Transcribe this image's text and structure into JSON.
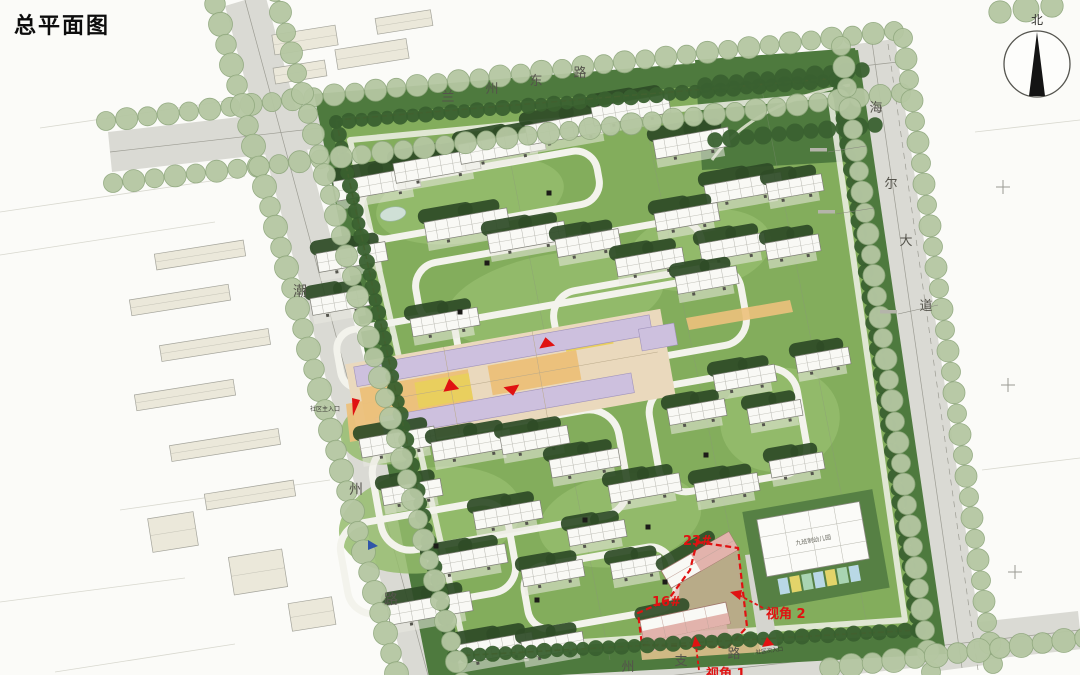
{
  "title": "总平面图",
  "compass": {
    "north_label": "北"
  },
  "roads": {
    "north": {
      "name": "兰州东路",
      "chars": [
        {
          "c": "兰",
          "x": 448,
          "y": 101
        },
        {
          "c": "州",
          "x": 492,
          "y": 93
        },
        {
          "c": "东",
          "x": 536,
          "y": 85
        },
        {
          "c": "路",
          "x": 580,
          "y": 77
        }
      ]
    },
    "east": {
      "name": "海尔大道",
      "chars": [
        {
          "c": "海",
          "x": 876,
          "y": 112
        },
        {
          "c": "尔",
          "x": 891,
          "y": 188
        },
        {
          "c": "大",
          "x": 906,
          "y": 245
        },
        {
          "c": "道",
          "x": 926,
          "y": 310
        }
      ]
    },
    "west": {
      "name": "潮州路",
      "chars": [
        {
          "c": "潮",
          "x": 300,
          "y": 296
        },
        {
          "c": "州",
          "x": 356,
          "y": 494
        },
        {
          "c": "路",
          "x": 391,
          "y": 604
        }
      ]
    },
    "south": {
      "name": "州支路",
      "chars": [
        {
          "c": "州",
          "x": 628,
          "y": 671
        },
        {
          "c": "支",
          "x": 681,
          "y": 665
        },
        {
          "c": "路",
          "x": 734,
          "y": 658
        }
      ]
    }
  },
  "annotations": {
    "building_23": {
      "label": "23#",
      "x": 697,
      "y": 541
    },
    "building_16": {
      "label": "16#",
      "x": 666,
      "y": 602
    },
    "viewpoint_2": {
      "label": "视角 2",
      "x": 789,
      "y": 614
    },
    "viewpoint_1": {
      "label": "视角 1",
      "x": 729,
      "y": 674
    },
    "main_entrance": {
      "label": "社区主入口",
      "x": 324,
      "y": 410
    },
    "secondary_entrance": {
      "label": "社区次入口",
      "x": 770,
      "y": 652
    },
    "kindergarten": {
      "label": "九班制幼儿园"
    }
  },
  "palette": {
    "lawn": "#83ad5c",
    "court": "#95bc6d",
    "tree_dark": "#2e4b27",
    "rim": "#39602f",
    "band": "#4e7a3e",
    "sage_fill": "#b5c7a2",
    "sage_edge": "#90a87e",
    "road": "#d9d9d3",
    "context": "#f3f3ee",
    "context_bldg": "#ebe8da",
    "building": "#f9f9f5",
    "lavender": "#cdc0de",
    "plaza": "#ecc17c",
    "yellow": "#e9cf5e",
    "pink": "#e2b3ac",
    "red": "#e01212",
    "boundary": "#d2622e"
  },
  "map": {
    "site_outline": "314,94 858,50 946,654 430,682",
    "lawn_outline": "330,118 840,74 924,634 450,660",
    "boundary_dash": "336,120 838,78 920,630 454,656",
    "highlight_parcel": "697,542 738,548 747,627 728,647 642,645 638,613 668,600 690,570",
    "buildings": [
      [
        377,
        184,
        86,
        20
      ],
      [
        437,
        166,
        86,
        20
      ],
      [
        502,
        147,
        86,
        20
      ],
      [
        568,
        128,
        84,
        20
      ],
      [
        631,
        110,
        78,
        19
      ],
      [
        692,
        143,
        76,
        19
      ],
      [
        744,
        188,
        78,
        19
      ],
      [
        795,
        187,
        56,
        17
      ],
      [
        352,
        257,
        70,
        19
      ],
      [
        467,
        225,
        84,
        20
      ],
      [
        527,
        237,
        78,
        19
      ],
      [
        588,
        243,
        64,
        18
      ],
      [
        650,
        262,
        68,
        18
      ],
      [
        687,
        217,
        64,
        18
      ],
      [
        733,
        247,
        66,
        18
      ],
      [
        793,
        247,
        54,
        17
      ],
      [
        340,
        302,
        58,
        17
      ],
      [
        445,
        322,
        68,
        18
      ],
      [
        707,
        280,
        62,
        18
      ],
      [
        745,
        378,
        62,
        17
      ],
      [
        823,
        360,
        54,
        17
      ],
      [
        697,
        412,
        58,
        17
      ],
      [
        775,
        412,
        54,
        16
      ],
      [
        398,
        442,
        76,
        19
      ],
      [
        472,
        445,
        80,
        19
      ],
      [
        535,
        440,
        68,
        18
      ],
      [
        585,
        463,
        70,
        18
      ],
      [
        645,
        488,
        72,
        18
      ],
      [
        727,
        487,
        64,
        18
      ],
      [
        797,
        465,
        54,
        17
      ],
      [
        412,
        492,
        60,
        17
      ],
      [
        508,
        515,
        68,
        18
      ],
      [
        597,
        533,
        58,
        17
      ],
      [
        467,
        560,
        80,
        19
      ],
      [
        553,
        573,
        62,
        17
      ],
      [
        430,
        608,
        84,
        20
      ],
      [
        495,
        648,
        78,
        19
      ],
      [
        553,
        645,
        62,
        17
      ],
      [
        637,
        567,
        52,
        16
      ]
    ],
    "context_buildings": [
      [
        200,
        255,
        90,
        16
      ],
      [
        180,
        300,
        100,
        16
      ],
      [
        215,
        345,
        110,
        16
      ],
      [
        185,
        395,
        100,
        16
      ],
      [
        225,
        445,
        110,
        16
      ],
      [
        250,
        495,
        90,
        16
      ],
      [
        305,
        40,
        64,
        20
      ],
      [
        372,
        54,
        72,
        20
      ],
      [
        300,
        72,
        52,
        16
      ],
      [
        404,
        22,
        56,
        16
      ],
      [
        173,
        532,
        46,
        34
      ],
      [
        258,
        572,
        54,
        38
      ],
      [
        312,
        614,
        44,
        28
      ]
    ],
    "sage_rows": [
      [
        106,
        121,
        894,
        31,
        11
      ],
      [
        113,
        183,
        901,
        93,
        11
      ],
      [
        275,
        -8,
        462,
        682,
        11
      ],
      [
        215,
        4,
        402,
        694,
        12
      ],
      [
        841,
        46,
        931,
        672,
        11
      ],
      [
        903,
        38,
        993,
        664,
        11
      ],
      [
        830,
        668,
        1085,
        638,
        12
      ],
      [
        1000,
        12,
        1052,
        6,
        13
      ]
    ],
    "rim_rows": [
      [
        336,
        122,
        836,
        80,
        8
      ],
      [
        838,
        80,
        918,
        630,
        8
      ],
      [
        918,
        630,
        454,
        656,
        8
      ],
      [
        336,
        122,
        454,
        656,
        8
      ]
    ],
    "park_rows": [
      [
        705,
        85,
        862,
        70,
        9
      ],
      [
        715,
        140,
        875,
        125,
        9
      ]
    ],
    "dots": [
      [
        549,
        193
      ],
      [
        460,
        312
      ],
      [
        487,
        263
      ],
      [
        436,
        546
      ],
      [
        648,
        527
      ],
      [
        585,
        520
      ],
      [
        706,
        455
      ],
      [
        537,
        600
      ],
      [
        665,
        582
      ]
    ],
    "crosses": [
      [
        1003,
        187
      ],
      [
        1008,
        385
      ],
      [
        1015,
        572
      ]
    ]
  }
}
